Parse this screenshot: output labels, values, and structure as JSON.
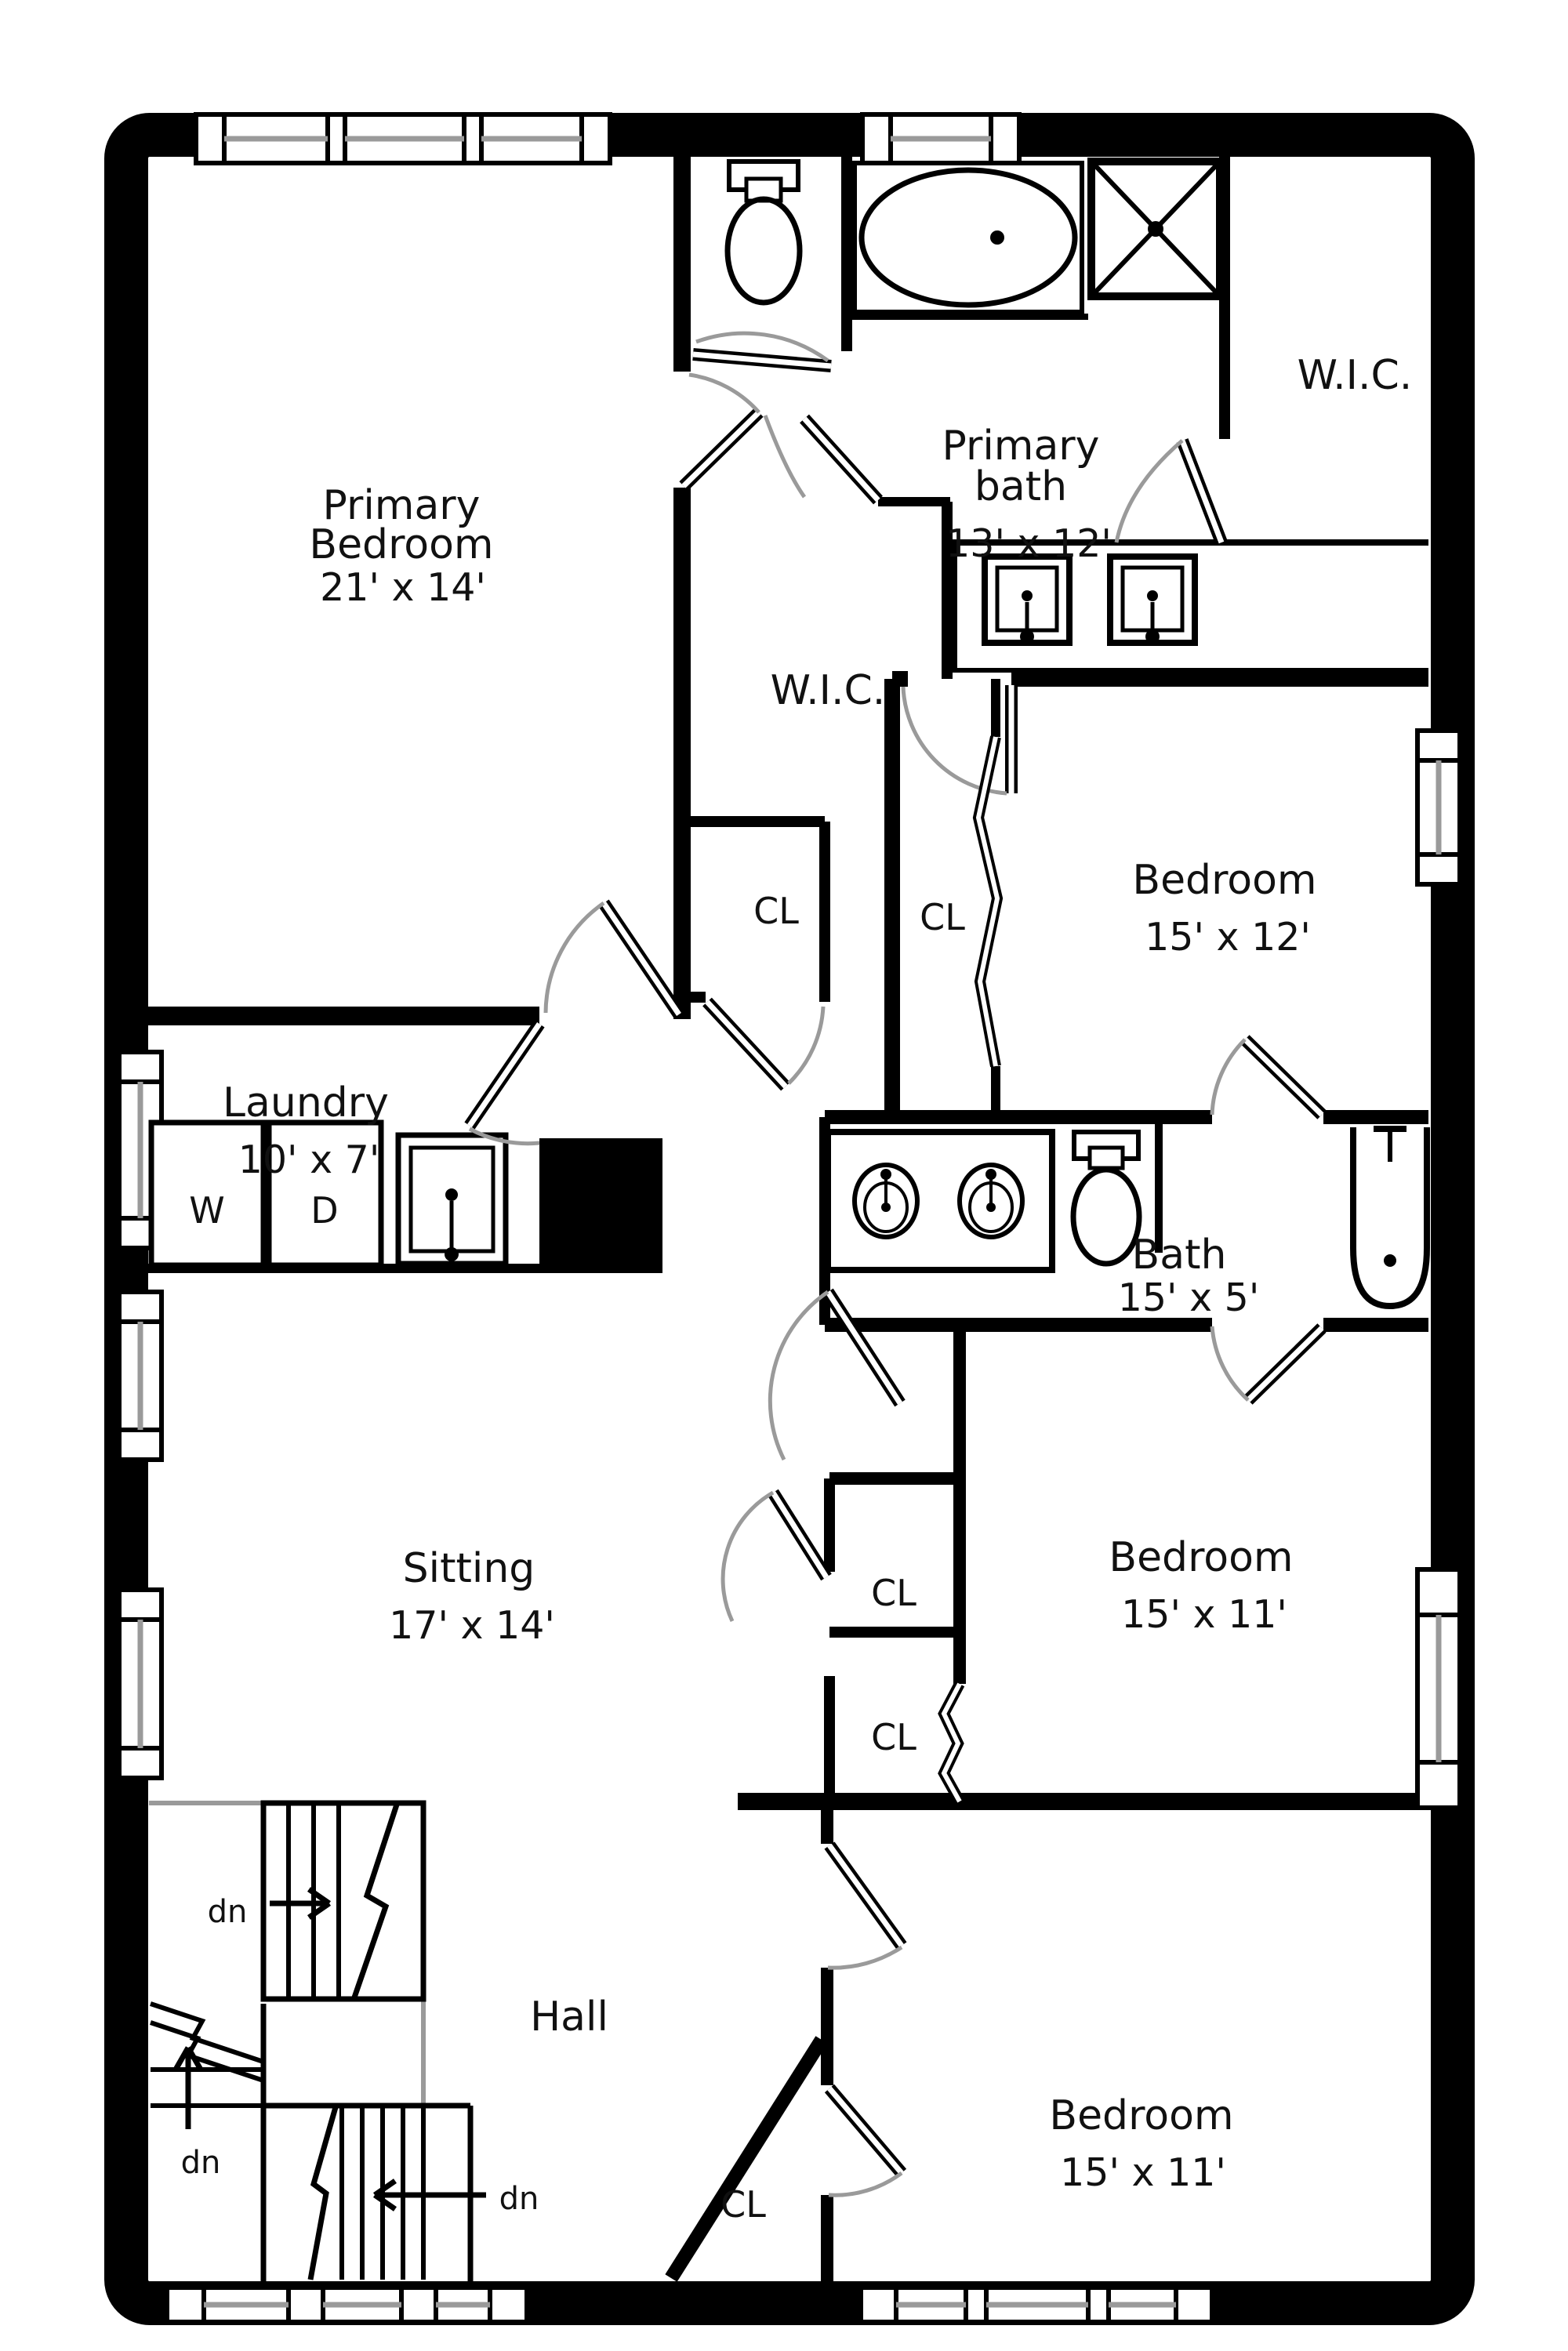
{
  "plan": {
    "title_hint": "second-floor residential floor plan",
    "colors": {
      "wall": "#000000",
      "door_swing": "#9a9a9a",
      "window_pane": "#8a8a8a",
      "background": "#ffffff"
    },
    "labels": {
      "primary_bedroom": {
        "l1": "Primary",
        "l2": "Bedroom",
        "dims": "21' x 14'"
      },
      "primary_bath": {
        "l1": "Primary",
        "l2": "bath",
        "dims": "13' x 12'"
      },
      "wic_right": "W.I.C.",
      "wic_mid": "W.I.C.",
      "bedroom_right_upper": {
        "l1": "Bedroom",
        "dims": "15' x 12'"
      },
      "bath": {
        "l1": "Bath",
        "dims": "15' x 5'"
      },
      "laundry": {
        "l1": "Laundry",
        "dims": "10' x 7'"
      },
      "sitting": {
        "l1": "Sitting",
        "dims": "17' x 14'"
      },
      "bedroom_right_lower": {
        "l1": "Bedroom",
        "dims": "15' x 11'"
      },
      "bedroom_bottom": {
        "l1": "Bedroom",
        "dims": "15' x 11'"
      },
      "hall": "Hall",
      "closets": {
        "mid": "CL",
        "bed12": "CL",
        "sitting_upper": "CL",
        "sitting_lower": "CL",
        "bottom": "CL"
      },
      "washer": "W",
      "dryer": "D",
      "stairs": {
        "dn1": "dn",
        "dn2": "dn",
        "dn3": "dn"
      }
    }
  }
}
